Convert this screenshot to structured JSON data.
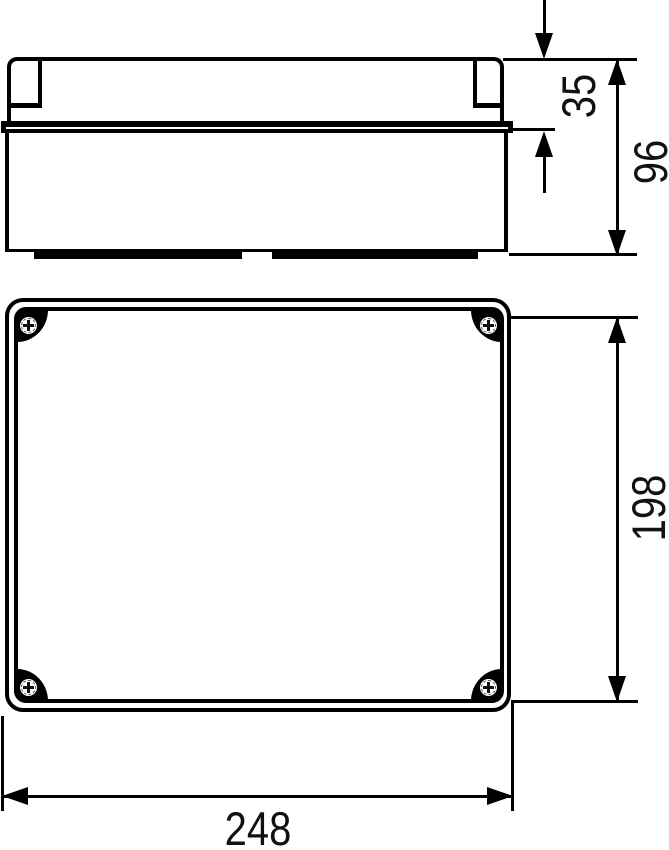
{
  "drawing": {
    "colors": {
      "background": "#ffffff",
      "line": "#000000",
      "text": "#111111"
    },
    "views": {
      "side_view": {
        "name": "box-side-elevation"
      },
      "top_view": {
        "name": "lid-top-view"
      }
    },
    "dimensions": {
      "lid_height": {
        "label": "35",
        "orientation": "vertical"
      },
      "total_height": {
        "label": "96",
        "orientation": "vertical"
      },
      "length": {
        "label": "198",
        "orientation": "vertical"
      },
      "width": {
        "label": "248",
        "orientation": "horizontal"
      }
    },
    "screws": {
      "icon": "phillips-screw-head-icon",
      "count": 4,
      "positions": [
        "top-left",
        "top-right",
        "bottom-left",
        "bottom-right"
      ]
    }
  }
}
